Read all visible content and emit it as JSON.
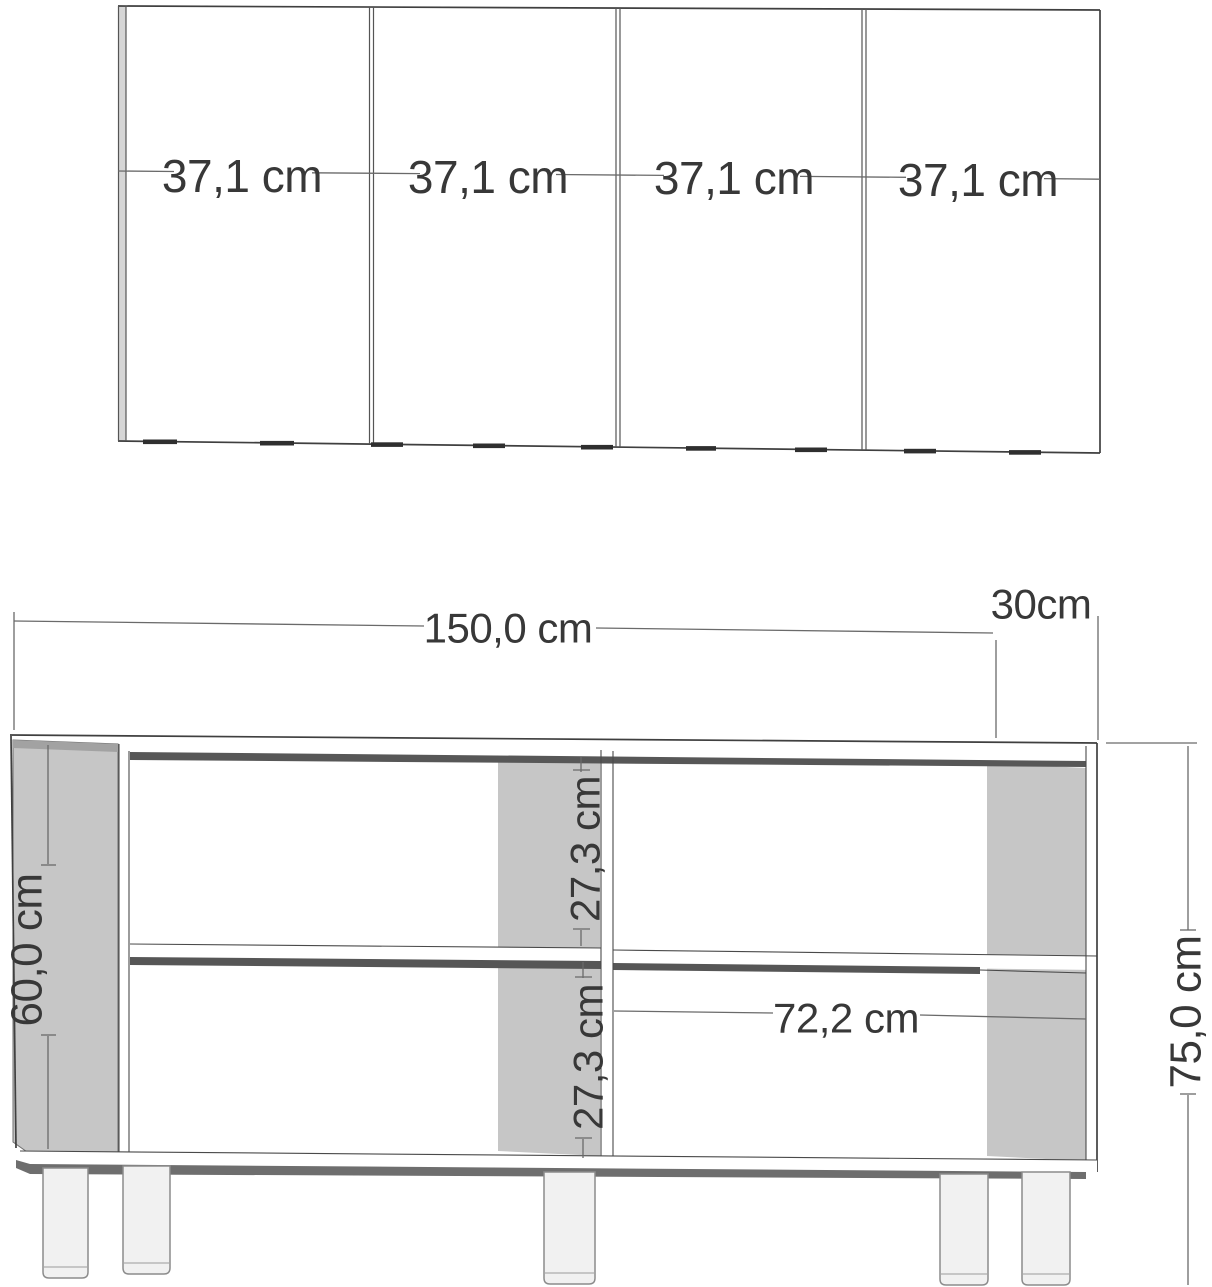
{
  "top_view": {
    "section_labels": [
      "37,1 cm",
      "37,1 cm",
      "37,1 cm",
      "37,1 cm"
    ]
  },
  "front_view": {
    "overall_width_label": "150,0 cm",
    "depth_label": "30cm",
    "carcass_height_label": "60,0 cm",
    "overall_height_label": "75,0 cm",
    "upper_shelf_height_label": "27,3 cm",
    "lower_shelf_height_label": "27,3 cm",
    "inner_width_label": "72,2 cm"
  },
  "colors": {
    "panel_gray": "#c6c6c6",
    "panel_gray_dark": "#a2a2a2",
    "shadow_dark": "#575757",
    "bottom_shadow": "#6e6e6e",
    "leg_fill": "#f1f1f1",
    "line": "#3f3f3f"
  }
}
